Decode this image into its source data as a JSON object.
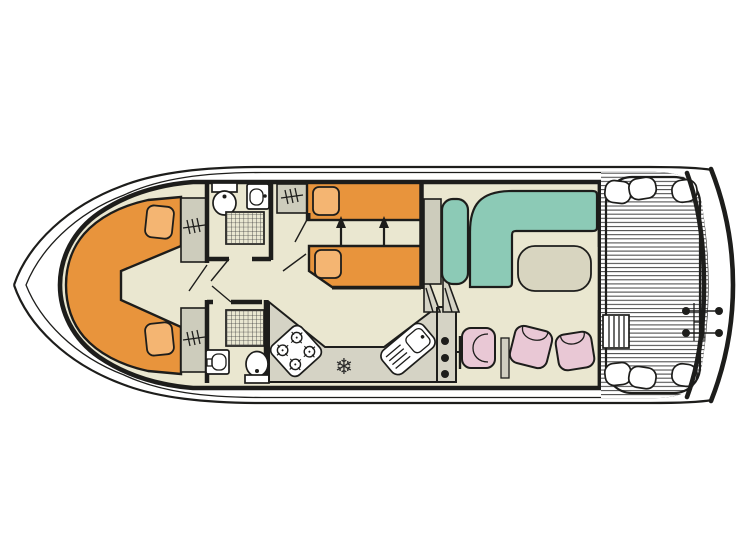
{
  "colors": {
    "outline": "#1d1d1b",
    "floor": "#eae7d0",
    "furniture_gray": "#cdccbc",
    "counter_gray": "#d5d3c5",
    "bed_orange": "#e8943c",
    "pillow_orange": "#f4b572",
    "sofa_teal": "#8ccab6",
    "chair_pink": "#e9c8d5",
    "table_beige": "#d8d5c0",
    "shower_base": "#e9e7d1",
    "slat_gray": "#4a4a4a",
    "white": "#ffffff"
  },
  "icons": {
    "fridge_snowflake": "❄"
  },
  "floor_plan": {
    "type": "houseboat-deck-plan",
    "orientation": "bow-left",
    "areas": [
      {
        "name": "bow-cabin",
        "furniture": [
          "v-shaped-double-bed",
          "two-pillows",
          "two-wardrobes"
        ]
      },
      {
        "name": "forward-bathroom",
        "fixtures": [
          "toilet",
          "washbasin",
          "shower"
        ]
      },
      {
        "name": "middle-cabin",
        "furniture": [
          "two-single-beds",
          "two-pillows",
          "wardrobe",
          "slide-together-arrows"
        ]
      },
      {
        "name": "aft-bathroom",
        "fixtures": [
          "shower",
          "washbasin",
          "toilet"
        ]
      },
      {
        "name": "galley",
        "fixtures": [
          "four-burner-stove",
          "refrigerator",
          "sink-with-drainer"
        ]
      },
      {
        "name": "helm",
        "fixtures": [
          "companionway-steps",
          "console",
          "helm-seat"
        ]
      },
      {
        "name": "saloon",
        "furniture": [
          "bench-sofa",
          "l-shaped-sofa",
          "table",
          "two-folding-chairs"
        ]
      },
      {
        "name": "aft-deck",
        "fixtures": [
          "slatted-floor",
          "perimeter-rail",
          "corner-cushions",
          "deck-steps"
        ]
      },
      {
        "name": "stern-platform",
        "fixtures": [
          "boarding-ladder"
        ]
      }
    ]
  }
}
